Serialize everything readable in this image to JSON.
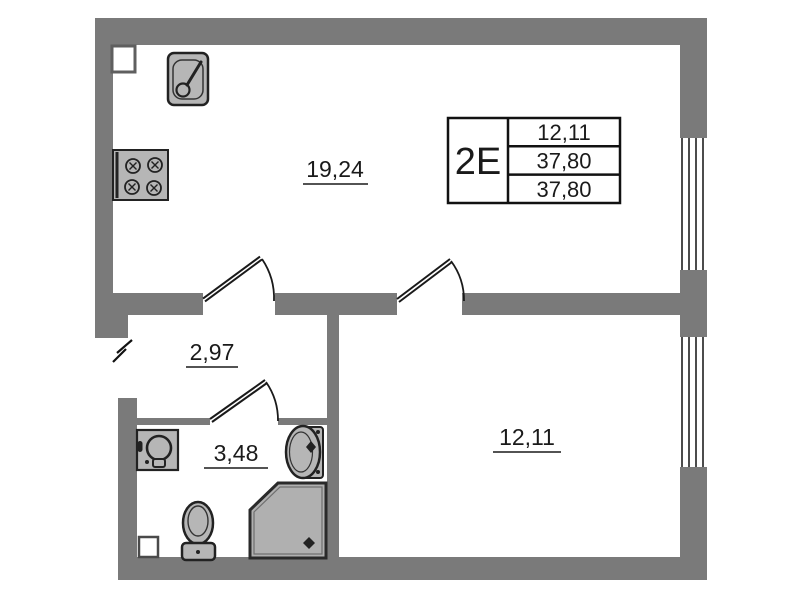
{
  "floor_plan": {
    "unit_table": {
      "code": "2E",
      "values": [
        "12,11",
        "37,80",
        "37,80"
      ]
    },
    "areas": {
      "living_room": "19,24",
      "hallway": "2,97",
      "bathroom": "3,48",
      "bedroom": "12,11"
    },
    "icons": [
      "kitchen-sink-icon",
      "stove-icon",
      "washing-machine-icon",
      "bathroom-sink-icon",
      "toilet-icon",
      "shower-icon",
      "window-icon",
      "door-swing-icon",
      "entry-break-icon"
    ],
    "colors": {
      "wall": "#7a7a7a",
      "fixture_fill": "#b6b6b6",
      "fixture_outline": "#222222",
      "shower_fill": "#b0b0b0",
      "text": "#1a1a1a",
      "background": "#ffffff"
    }
  }
}
